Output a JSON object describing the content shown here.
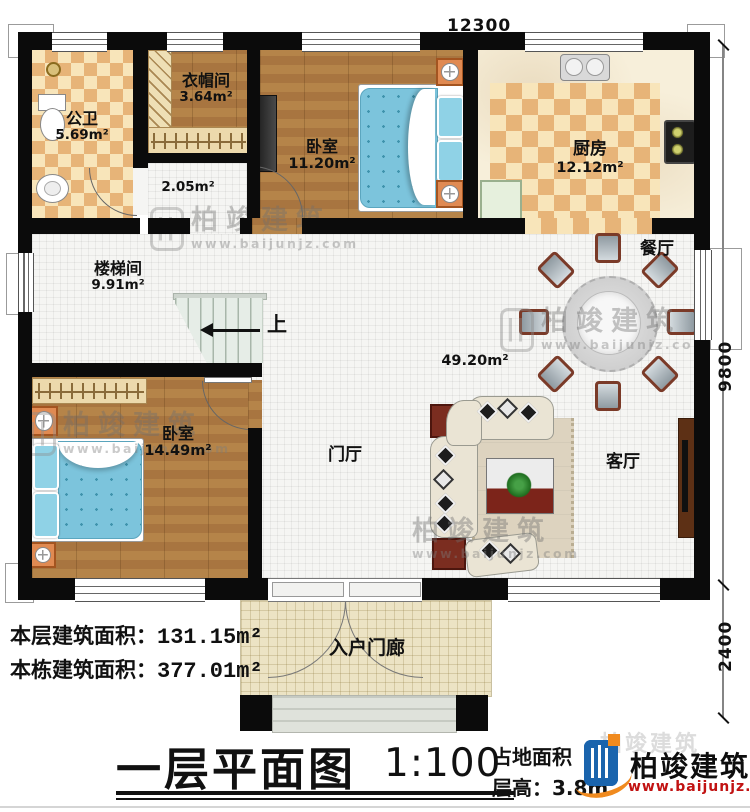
{
  "brand": {
    "name": "柏竣建筑",
    "url": "www.baijunjz.com"
  },
  "dimensions": {
    "top": "12300",
    "right": "9800",
    "bottom_right": "2400"
  },
  "rooms": [
    {
      "name": "公卫",
      "area": "5.69m²"
    },
    {
      "name": "衣帽间",
      "area": "3.64m²"
    },
    {
      "name": "卧室",
      "area": "11.20m²"
    },
    {
      "name": "厨房",
      "area": "12.12m²"
    },
    {
      "name": "",
      "area": "2.05m²"
    },
    {
      "name": "楼梯间",
      "area": "9.91m²"
    },
    {
      "name": "卧室",
      "area": "14.49m²"
    },
    {
      "name": "门厅",
      "area": ""
    },
    {
      "name": "餐厅",
      "area": ""
    },
    {
      "name": "客厅",
      "area": ""
    },
    {
      "name": "",
      "area": "49.20m²"
    },
    {
      "name": "入户门廊",
      "area": ""
    }
  ],
  "stairs": {
    "direction_label": "上"
  },
  "footer": {
    "floor_area_label": "本层建筑面积：",
    "floor_area_value": "131.15m²",
    "total_area_label": "本栋建筑面积：",
    "total_area_value": "377.01m²",
    "plan_title": "一层平面图",
    "plan_scale": "1:100",
    "land_area_label": "占地面积",
    "floor_height_label": "层高：",
    "floor_height_value": "3.8m"
  },
  "colors": {
    "wall": "#0b0b0b",
    "accent_blue": "#1a64ad",
    "accent_orange": "#f08a1e",
    "url_red": "#c11212"
  }
}
